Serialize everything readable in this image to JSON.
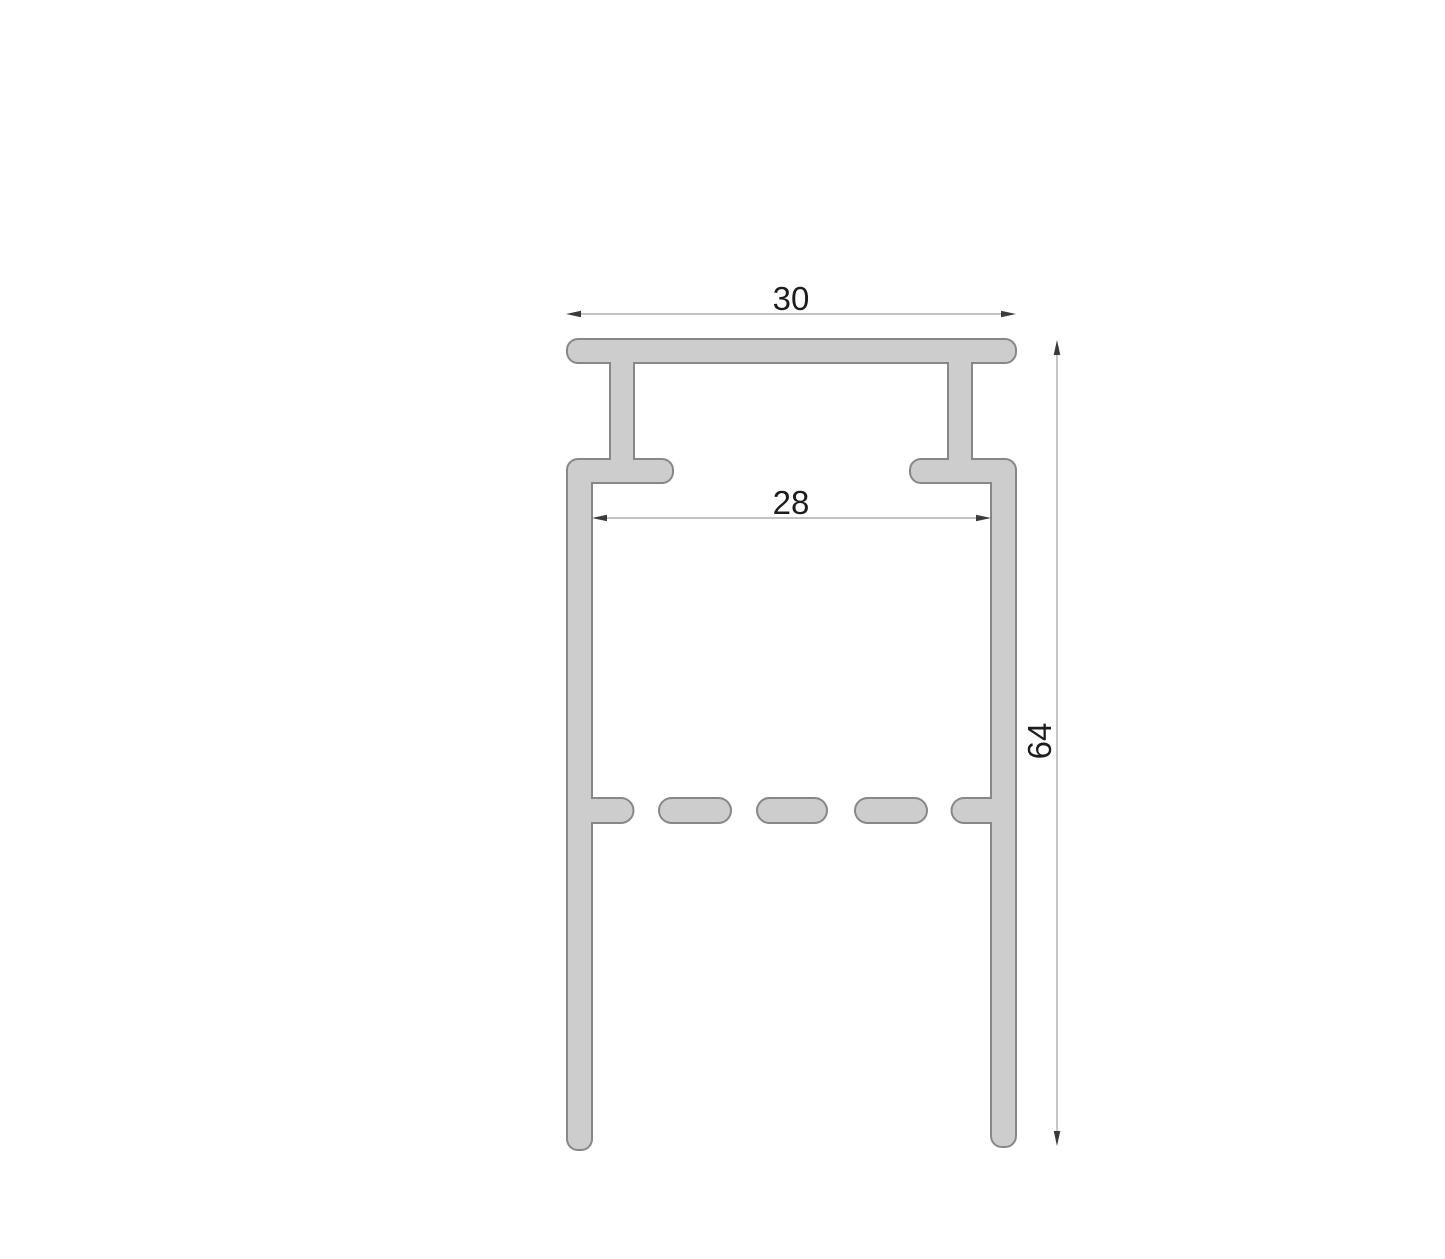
{
  "drawing": {
    "dimension_labels": {
      "top_width": "30",
      "inner_opening": "28",
      "overall_height": "64"
    },
    "colors": {
      "profile_fill": "#cdcdcd",
      "profile_stroke": "#878787",
      "dimension_line": "#9f9f9f",
      "arrowhead": "#3a3a3a",
      "label_text": "#1d1d1d",
      "background": "#ffffff"
    }
  }
}
